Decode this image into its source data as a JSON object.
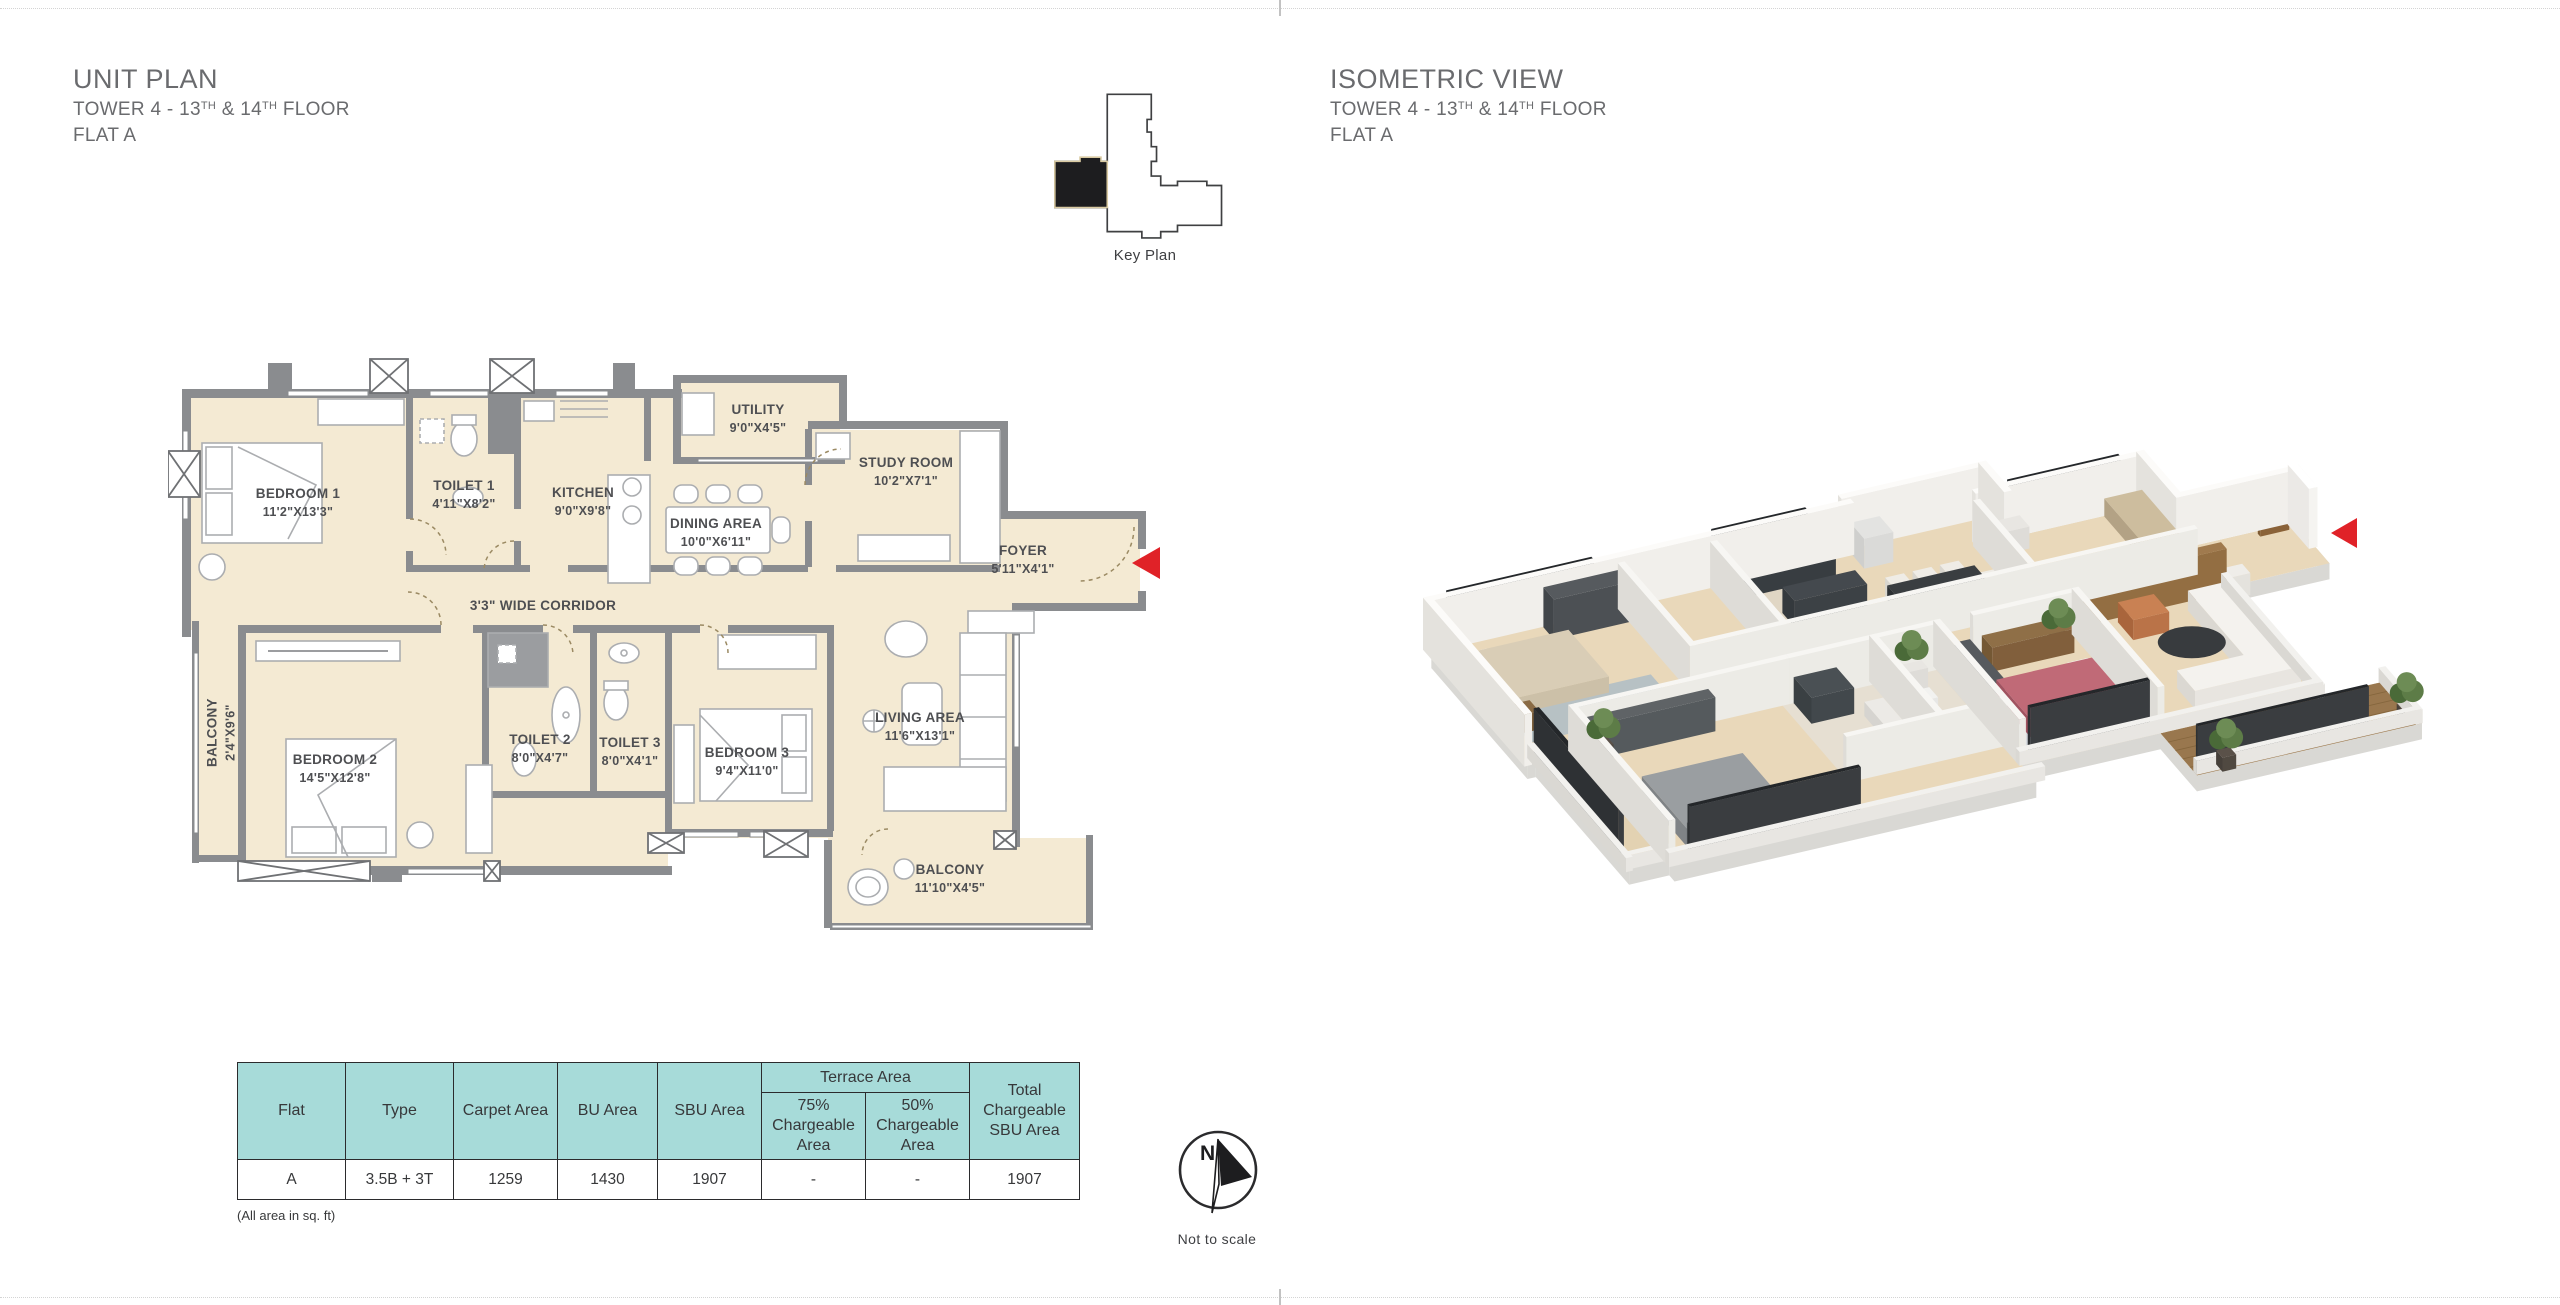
{
  "unit_panel": {
    "title": "UNIT PLAN",
    "subtitle": {
      "t1": "TOWER 4 - 13",
      "s1": "TH",
      "t2": " & 14",
      "s2": "TH",
      "t3": " FLOOR"
    },
    "flat": "FLAT A"
  },
  "iso_panel": {
    "title": "ISOMETRIC VIEW",
    "subtitle": {
      "t1": "TOWER 4 - 13",
      "s1": "TH",
      "t2": " & 14",
      "s2": "TH",
      "t3": " FLOOR"
    },
    "flat": "FLAT A"
  },
  "key_plan": {
    "label": "Key Plan"
  },
  "compass": {
    "n": "N",
    "note": "Not to scale"
  },
  "rooms": [
    {
      "name": "BEDROOM 1",
      "dims": "11'2\"X13'3\""
    },
    {
      "name": "TOILET 1",
      "dims": "4'11\"X8'2\""
    },
    {
      "name": "KITCHEN",
      "dims": "9'0\"X9'8\""
    },
    {
      "name": "UTILITY",
      "dims": "9'0\"X4'5\""
    },
    {
      "name": "STUDY ROOM",
      "dims": "10'2\"X7'1\""
    },
    {
      "name": "DINING AREA",
      "dims": "10'0\"X6'11\""
    },
    {
      "name": "FOYER",
      "dims": "5'11\"X4'1\""
    },
    {
      "name": "3'3\" WIDE CORRIDOR",
      "dims": ""
    },
    {
      "name": "BALCONY",
      "dims": "2'4\"X9'6\""
    },
    {
      "name": "BEDROOM 2",
      "dims": "14'5\"X12'8\""
    },
    {
      "name": "TOILET 2",
      "dims": "8'0\"X4'7\""
    },
    {
      "name": "TOILET 3",
      "dims": "8'0\"X4'1\""
    },
    {
      "name": "BEDROOM 3",
      "dims": "9'4\"X11'0\""
    },
    {
      "name": "LIVING AREA",
      "dims": "11'6\"X13'1\""
    },
    {
      "name": "BALCONY",
      "dims": "11'10\"X4'5\""
    }
  ],
  "table": {
    "headers": {
      "flat": "Flat",
      "type": "Type",
      "carpet": "Carpet Area",
      "bu": "BU Area",
      "sbu": "SBU Area",
      "terrace": "Terrace Area",
      "t75": "75% Chargeable Area",
      "t50": "50% Chargeable Area",
      "total": "Total Chargeable SBU Area"
    },
    "row": {
      "flat": "A",
      "type": "3.5B + 3T",
      "carpet": "1259",
      "bu": "1430",
      "sbu": "1907",
      "t75": "-",
      "t50": "-",
      "total": "1907"
    },
    "footnote": "(All area in sq. ft)"
  },
  "icons": {
    "entry_arrow": "left-filled-triangle",
    "compass_needle": "north-arrow"
  },
  "colors": {
    "cream": "#f4ead3",
    "wall_gray": "#8a8c8f",
    "table_teal": "#a7dbd9",
    "accent_red": "#e02228",
    "ink": "#37383a",
    "title_gray": "#6a6b6e"
  }
}
